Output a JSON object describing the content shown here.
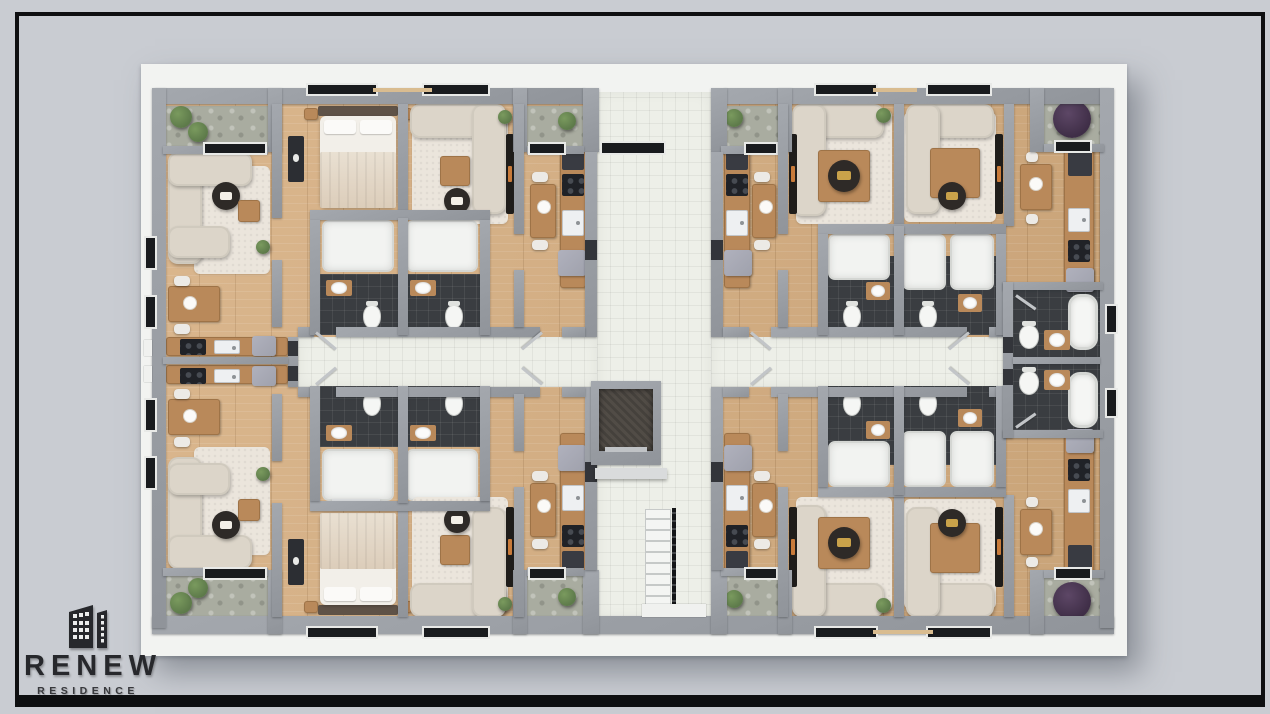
{
  "logo": {
    "icon": "buildings-icon",
    "brand": "RENEW",
    "sub": "RESIDENCE"
  },
  "palette": {
    "background": "#c9ccd2",
    "frame": "#0e0f11",
    "slab": "#f2f3f1",
    "wall": "#90949a",
    "wall_top": "#a4a8ae",
    "wood_floor": "#d6ae80",
    "tile": "#edefe8",
    "dark_tile": "#3a3d41",
    "stone": "#a9aca0",
    "sofa": "#dcd5c9",
    "rug": "#ebe5dc",
    "wood_furniture": "#b9895a",
    "appliance": "#9fa1ac",
    "plant_green": "#5d7a4a",
    "plant_purple": "#3f2e47",
    "table_dark": "#2e2a27",
    "window": "#191b1e",
    "logo_ink": "#27282c"
  }
}
